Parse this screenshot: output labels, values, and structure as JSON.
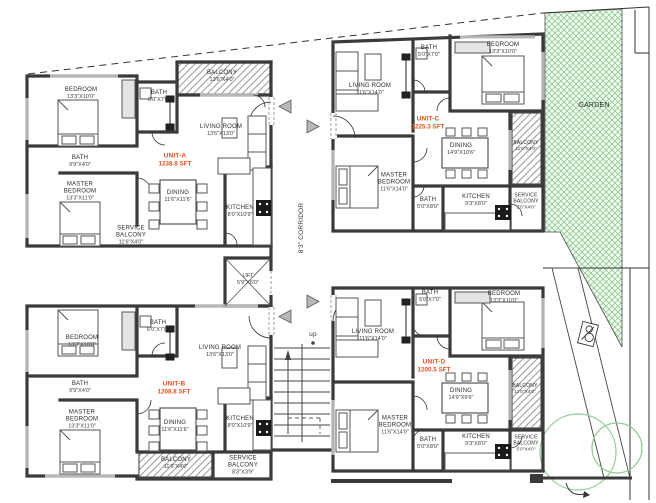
{
  "drawing": {
    "corridor_label": "8'3\" CORRIDOR",
    "garden_label": "GARDEN",
    "stairs_up_label": "up",
    "lift": {
      "name": "LIFT",
      "dim": "5'9\"X6'0\""
    }
  },
  "colors": {
    "wall": "#3a3a3a",
    "unit_label": "#e8501e",
    "garden": "#7cc47e",
    "tree": "#8ccd8f",
    "balcony_hatch": "#9a9a9a"
  },
  "units": [
    {
      "id": "unit-a",
      "name": "UNIT-A",
      "area": "1238.8 SFT",
      "rooms": [
        {
          "name": "BEDROOM",
          "dim": "13'3\"X10'0\""
        },
        {
          "name": "BATH",
          "dim": "6'0\"X7'0\""
        },
        {
          "name": "BALCONY",
          "dim": "13'6\"X4'0\""
        },
        {
          "name": "LIVING ROOM",
          "dim": "13'6\"X13'0\""
        },
        {
          "name": "BATH",
          "dim": "9'9\"X4'0\""
        },
        {
          "name": "MASTER BEDROOM",
          "dim": "13'3\"X11'0\""
        },
        {
          "name": "DINING",
          "dim": "11'6\"X11'6\""
        },
        {
          "name": "KITCHEN",
          "dim": "8'0\"X10'9\""
        },
        {
          "name": "SERVICE BALCONY",
          "dim": "11'6\"X4'0\""
        }
      ]
    },
    {
      "id": "unit-b",
      "name": "UNIT-B",
      "area": "1208.8 SFT",
      "rooms": [
        {
          "name": "BEDROOM",
          "dim": "13'3\"X10'0\""
        },
        {
          "name": "BATH",
          "dim": "6'0\"X7'0\""
        },
        {
          "name": "LIVING ROOM",
          "dim": "13'6\"X13'0\""
        },
        {
          "name": "BATH",
          "dim": "9'9\"X4'0\""
        },
        {
          "name": "MASTER BEDROOM",
          "dim": "13'3\"X11'0\""
        },
        {
          "name": "DINING",
          "dim": "11'6\"X11'6\""
        },
        {
          "name": "KITCHEN",
          "dim": "8'0\"X10'9\""
        },
        {
          "name": "BALCONY",
          "dim": "11'6\"X4'0\""
        },
        {
          "name": "SERVICE BALCONY",
          "dim": "8'3\"X3'9\""
        }
      ]
    },
    {
      "id": "unit-c",
      "name": "UNIT-C",
      "area": "1225.3 SFT",
      "rooms": [
        {
          "name": "LIVING ROOM",
          "dim": "11'6\"X14'0\""
        },
        {
          "name": "BATH",
          "dim": "5'0\"X7'0\""
        },
        {
          "name": "BEDROOM",
          "dim": "13'3\"X10'0\""
        },
        {
          "name": "DINING",
          "dim": "14'9\"X10'6\""
        },
        {
          "name": "MASTER BEDROOM",
          "dim": "11'6\"X14'0\""
        },
        {
          "name": "BATH",
          "dim": "5'0\"X8'0\""
        },
        {
          "name": "KITCHEN",
          "dim": "9'3\"X8'0\""
        },
        {
          "name": "SERVICE BALCONY",
          "dim": "5'0\"X4'0\""
        },
        {
          "name": "BALCONY",
          "dim": "11'0\"X4'0\""
        }
      ]
    },
    {
      "id": "unit-d",
      "name": "UNIT-D",
      "area": "1200.5 SFT",
      "rooms": [
        {
          "name": "LIVING ROOM",
          "dim": "11'6\"X14'0\""
        },
        {
          "name": "BATH",
          "dim": "5'0\"X7'0\""
        },
        {
          "name": "BEDROOM",
          "dim": "13'3\"X10'0\""
        },
        {
          "name": "DINING",
          "dim": "14'9\"X9'6\""
        },
        {
          "name": "BALCONY",
          "dim": "11'0\"X4'0\""
        },
        {
          "name": "MASTER BEDROOM",
          "dim": "11'6\"X14'0\""
        },
        {
          "name": "BATH",
          "dim": "5'0\"X8'0\""
        },
        {
          "name": "KITCHEN",
          "dim": "9'3\"X8'0\""
        },
        {
          "name": "SERVICE BALCONY",
          "dim": "5'0\"X4'0\""
        }
      ]
    }
  ]
}
